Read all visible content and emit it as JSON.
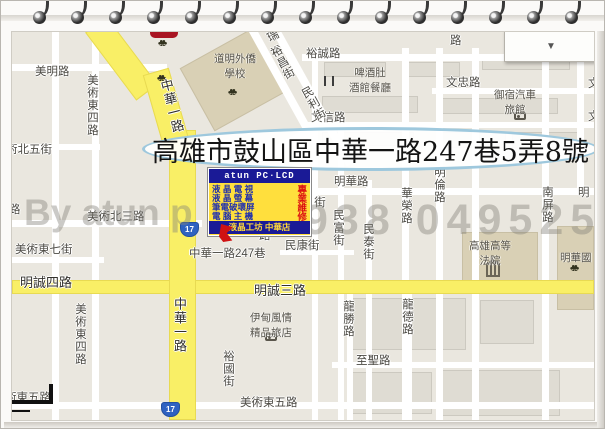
{
  "banner": {
    "text": "高雄市鼓山區中華一路247巷5弄8號"
  },
  "watermark": {
    "left": "By atun p",
    "right": "938 049525 曾"
  },
  "map_control": {
    "arrow": "▼"
  },
  "shield_label": "17",
  "ad_box": {
    "header": "atun PC·LCD",
    "lines": [
      {
        "main": "液 晶 電 視",
        "accent": "專"
      },
      {
        "main": "液 晶 螢 幕",
        "accent": "業"
      },
      {
        "main": "筆電破壞屏",
        "accent": "維"
      },
      {
        "main": "電 腦 主 機",
        "accent": "修"
      }
    ],
    "footer": "液晶工坊 中華店"
  },
  "street_labels": [
    "美明路",
    "美術東四路",
    "術北五街",
    "路",
    "美術北三路",
    "美術東七街",
    "明誠四路",
    "美術東四路",
    "中華一路",
    "中華一路",
    "術東五路",
    "美術東五路",
    "裕國街",
    "中華一路247巷",
    "明誠三路",
    "民康街",
    "街",
    "路",
    "民富街",
    "民泰街",
    "明華路",
    "華榮路",
    "明倫路",
    "南屏路",
    "明",
    "龍勝路",
    "龍德路",
    "至聖路",
    "裕誠路",
    "路",
    "文忠路",
    "文信路",
    "文",
    "文",
    "瑞",
    "裕昌街",
    "民利街"
  ],
  "pois": [
    {
      "line1": "道明外僑",
      "line2": "學校"
    },
    {
      "line1": "啤酒肚",
      "line2": "酒館餐廳"
    },
    {
      "line1": "御宿汽車",
      "line2": "旅館"
    },
    {
      "line1": "高雄高等",
      "line2": "法院"
    },
    {
      "line1": "明華國",
      "line2": ""
    },
    {
      "line1": "伊甸風情",
      "line2": "精品旅店"
    }
  ],
  "icons": {
    "tree": "♣♣"
  },
  "colors": {
    "road_major": "#f9ef66",
    "block": "#eae7df",
    "poi_block": "#d9d0b5",
    "ad_navy": "#1a1a96",
    "ad_yellow": "#ffdf3d",
    "ad_red": "#dd1111",
    "banner_stroke": "#9ec8dd",
    "shield_blue": "#2f62c1"
  }
}
